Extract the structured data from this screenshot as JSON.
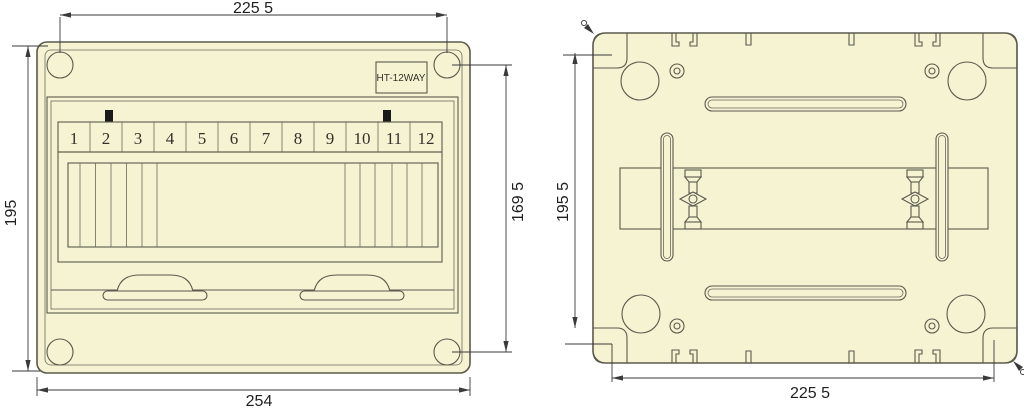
{
  "drawing": {
    "product_label": "HT-12WAY",
    "front_view": {
      "module_numbers": [
        "1",
        "2",
        "3",
        "4",
        "5",
        "6",
        "7",
        "8",
        "9",
        "10",
        "11",
        "12"
      ],
      "dimensions": {
        "top_width": "225 5",
        "left_height": "195",
        "right_height": "169 5",
        "bottom_width": "254"
      }
    },
    "back_view": {
      "dimensions": {
        "left_height": "195 5",
        "bottom_width": "225 5"
      }
    },
    "colors": {
      "body_fill": "#F6F3D3",
      "outline": "#5B5A4C",
      "dimension_line": "#3A3A3A",
      "busbar_marker": "#1A1A1A",
      "background": "#FFFFFF"
    }
  }
}
